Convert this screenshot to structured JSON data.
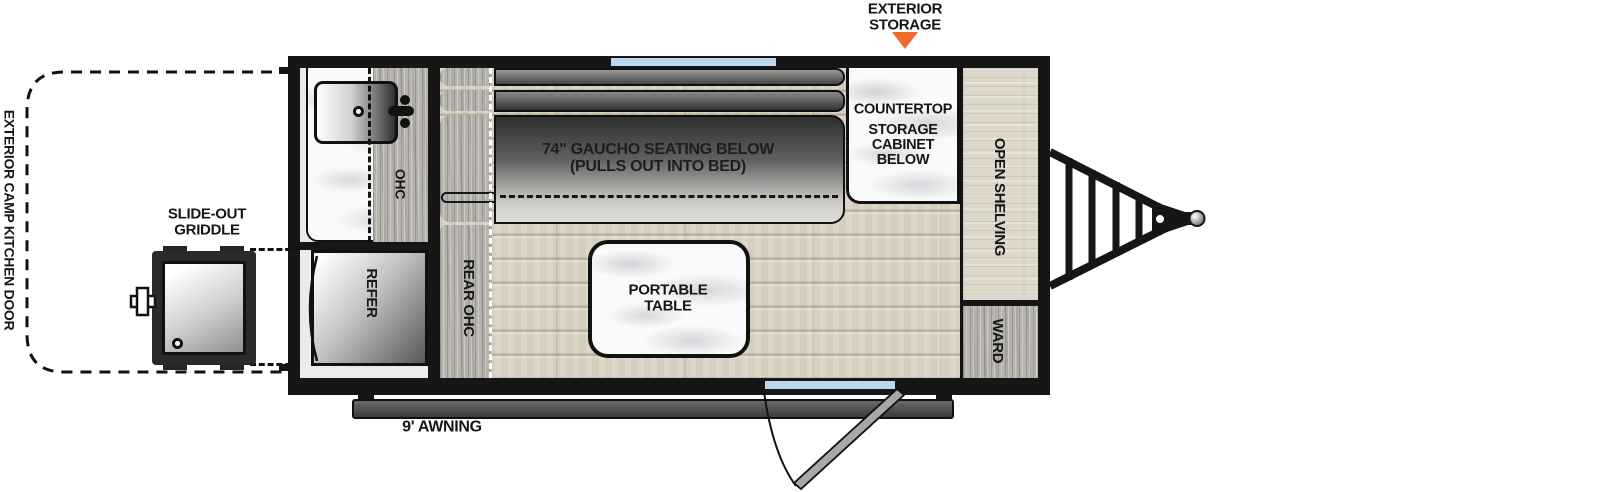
{
  "callout": {
    "line1": "EXTERIOR",
    "line2": "STORAGE"
  },
  "exterior": {
    "camp_kitchen_door": "EXTERIOR CAMP KITCHEN DOOR",
    "griddle_line1": "SLIDE-OUT",
    "griddle_line2": "GRIDDLE",
    "awning": "9' AWNING"
  },
  "kitchen": {
    "ohc": "OHC",
    "refer": "REFER"
  },
  "interior": {
    "rear_ohc": "REAR OHC",
    "gaucho_line1": "74\" GAUCHO SEATING BELOW",
    "gaucho_line2": "(PULLS OUT INTO BED)",
    "table_line1": "PORTABLE",
    "table_line2": "TABLE",
    "countertop": "COUNTERTOP",
    "cabinet_line1": "STORAGE",
    "cabinet_line2": "CABINET",
    "cabinet_line3": "BELOW",
    "open_shelving": "OPEN SHELVING",
    "ward": "WARD"
  },
  "colors": {
    "callout_orange": "#F26A2A",
    "window_blue": "#BCD6EE",
    "wall_black": "#161616"
  }
}
